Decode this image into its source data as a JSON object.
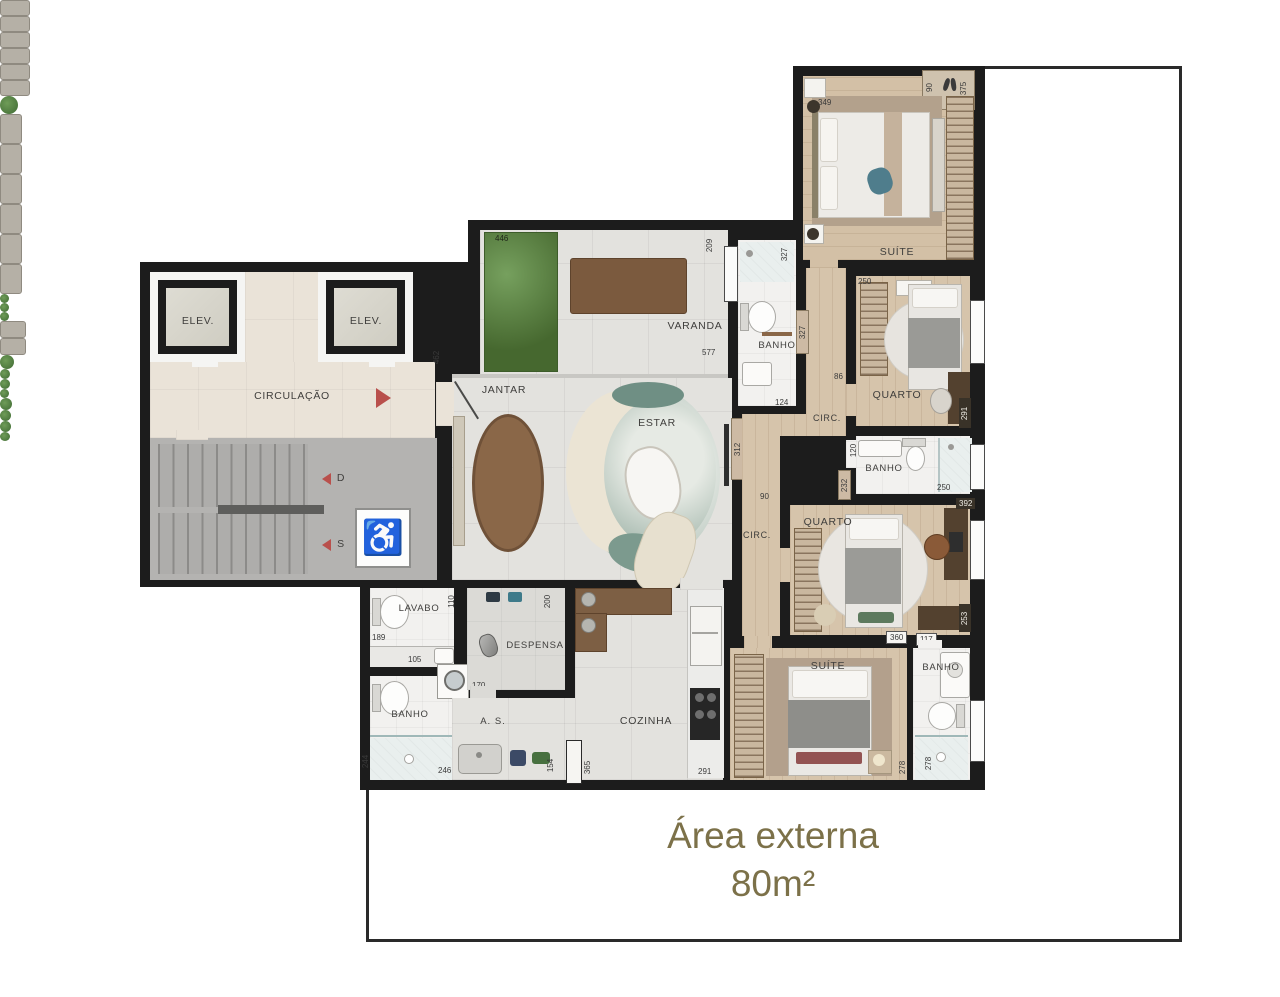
{
  "title": {
    "line1": "Área externa",
    "line2": "80m²"
  },
  "labels": {
    "elev_left": "ELEV.",
    "elev_right": "ELEV.",
    "circulacao": "CIRCULAÇÃO",
    "varanda": "VARANDA",
    "jantar": "JANTAR",
    "estar": "ESTAR",
    "banho_top": "BANHO",
    "suite_top": "SUÍTE",
    "quarto_top": "QUARTO",
    "circ_top": "CIRC.",
    "banho_mid": "BANHO",
    "quarto_mid": "QUARTO",
    "circ_mid": "CIRC.",
    "lavabo": "LAVABO",
    "despensa": "DESPENSA",
    "banho_bottom_left": "BANHO",
    "area_servico": "A. S.",
    "cozinha": "COZINHA",
    "suite_bottom": "SUÍTE",
    "banho_bottom_right": "BANHO",
    "stair_down": "D",
    "stair_up": "S"
  },
  "dimensions": {
    "d349": "349",
    "d90a": "90",
    "d375": "375",
    "d446": "446",
    "d209": "209",
    "d327a": "327",
    "d327b": "327",
    "d462": "462",
    "d577": "577",
    "d124": "124",
    "d312": "312",
    "d250a": "250",
    "d291a": "291",
    "d86": "86",
    "d120": "120",
    "d232": "232",
    "d250b": "250",
    "d392": "392",
    "d90b": "90",
    "d253": "253",
    "d360": "360",
    "d117": "117",
    "d110": "110",
    "d189": "189",
    "d200": "200",
    "d105": "105",
    "d170": "170",
    "d244": "244",
    "d246": "246",
    "d154": "154",
    "d365": "365",
    "d291b": "291",
    "d278a": "278",
    "d278b": "278"
  },
  "icons": {
    "wheelchair": "♿"
  },
  "colors": {
    "wall": "#1c1c1c",
    "accent_red": "#b9504c",
    "title": "#7c7149",
    "wood_floor": "#d6c4ab",
    "tile_floor": "#e3e2de",
    "bath_floor": "#f2f1ef",
    "circulation_floor": "#eae3d8",
    "planter_green": "#5f8350"
  }
}
